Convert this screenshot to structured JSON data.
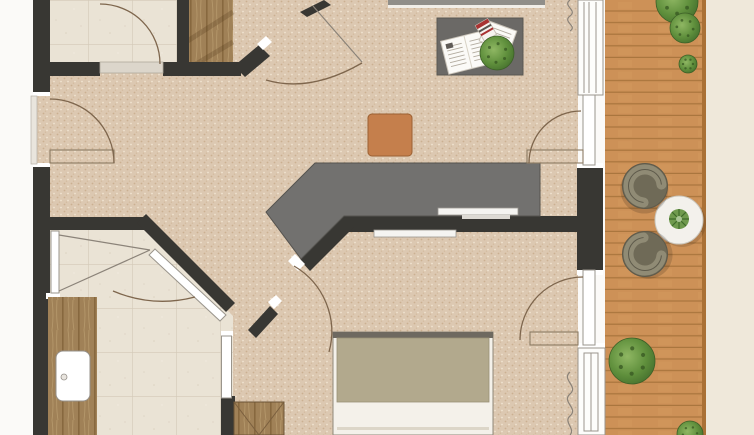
{
  "app": {
    "name": "apartment-floor-plan",
    "description": "Top-down architectural floor plan: living area with kitchen counter, bathroom, sleeping area and wooden balcony deck"
  },
  "colors": {
    "wall": "#383733",
    "bandDark": "#343330",
    "cap": "#ffffff",
    "white": "#fbfaf8",
    "carpetBase": "#dcc8b1",
    "carpetDot1": "#cbb091",
    "carpetDot2": "#efe3d0",
    "tileBase": "#eae3d5",
    "tileLine": "#d3c9b7",
    "woodBase": "#a08157",
    "woodLine": "#87683f",
    "deckBase": "#cd9157",
    "deckLine": "#a9753d",
    "deckEdge": "#aa7136",
    "exterior": "#efe8da",
    "counter": "#72716f",
    "counterEdge": "#55534f",
    "tableGray": "#6b6966",
    "ottoman": "#c57f4c",
    "ottomanEdge": "#9c6133",
    "bedSheet": "#f4f1ea",
    "bedBlanket": "#b2a98d",
    "bedHead": "#6e6960",
    "wardrobeLine": "#7a5f3e",
    "chairBody": "#6f6a57",
    "chairRing": "#908b75",
    "chairStroke": "#5e5a4b",
    "roundTable": "#f3f1ec",
    "succulent": "#6f9a4e",
    "bushDark": "#3c5f27",
    "redBooklet": "#a93232",
    "grayTopBand": "#908e89"
  },
  "plan": {
    "rooms": [
      {
        "name": "living-area",
        "floor": "carpet"
      },
      {
        "name": "entry-tile-room",
        "floor": "tile"
      },
      {
        "name": "entry-wood-nook",
        "floor": "wood"
      },
      {
        "name": "bathroom",
        "floor": "tile"
      },
      {
        "name": "sleeping-area",
        "floor": "carpet"
      },
      {
        "name": "balcony",
        "floor": "deck"
      }
    ],
    "furniture": [
      {
        "name": "kitchen-counter",
        "shape": "angled-bar"
      },
      {
        "name": "coffee-table",
        "x": 437,
        "y": 18,
        "w": 86,
        "h": 57
      },
      {
        "name": "ottoman",
        "x": 368,
        "y": 114,
        "w": 44,
        "h": 42
      },
      {
        "name": "bed",
        "x": 333,
        "y": 332,
        "w": 160,
        "h": 103
      },
      {
        "name": "wardrobe",
        "x": 234,
        "y": 402,
        "w": 50,
        "h": 33
      },
      {
        "name": "bathroom-vanity",
        "x": 48,
        "y": 297,
        "w": 49,
        "h": 138
      },
      {
        "name": "sink",
        "x": 56,
        "y": 351,
        "w": 34,
        "h": 50
      },
      {
        "name": "balcony-round-table",
        "cx": 679,
        "cy": 220,
        "r": 24
      }
    ],
    "chairs": [
      {
        "cx": 645,
        "cy": 186,
        "facing": 45
      },
      {
        "cx": 645,
        "cy": 254,
        "facing": -45
      }
    ],
    "plants": [
      {
        "cx": 677,
        "cy": 2,
        "r": 21
      },
      {
        "cx": 685,
        "cy": 28,
        "r": 15
      },
      {
        "cx": 688,
        "cy": 64,
        "r": 9
      },
      {
        "cx": 632,
        "cy": 361,
        "r": 23
      },
      {
        "cx": 690,
        "cy": 434,
        "r": 13
      },
      {
        "cx": 497,
        "cy": 53,
        "r": 17
      }
    ],
    "doors": [
      {
        "name": "entry-door-left-wall"
      },
      {
        "name": "tile-room-door"
      },
      {
        "name": "main-room-double-door"
      },
      {
        "name": "bathroom-pivot-door"
      },
      {
        "name": "bathroom-diagonal-door"
      },
      {
        "name": "bedroom-door"
      },
      {
        "name": "balcony-door-upper"
      },
      {
        "name": "balcony-door-lower"
      }
    ],
    "windows": [
      {
        "name": "balcony-window-top"
      },
      {
        "name": "balcony-window-middle"
      },
      {
        "name": "balcony-window-bottom"
      },
      {
        "name": "top-edge-window-band"
      }
    ]
  }
}
